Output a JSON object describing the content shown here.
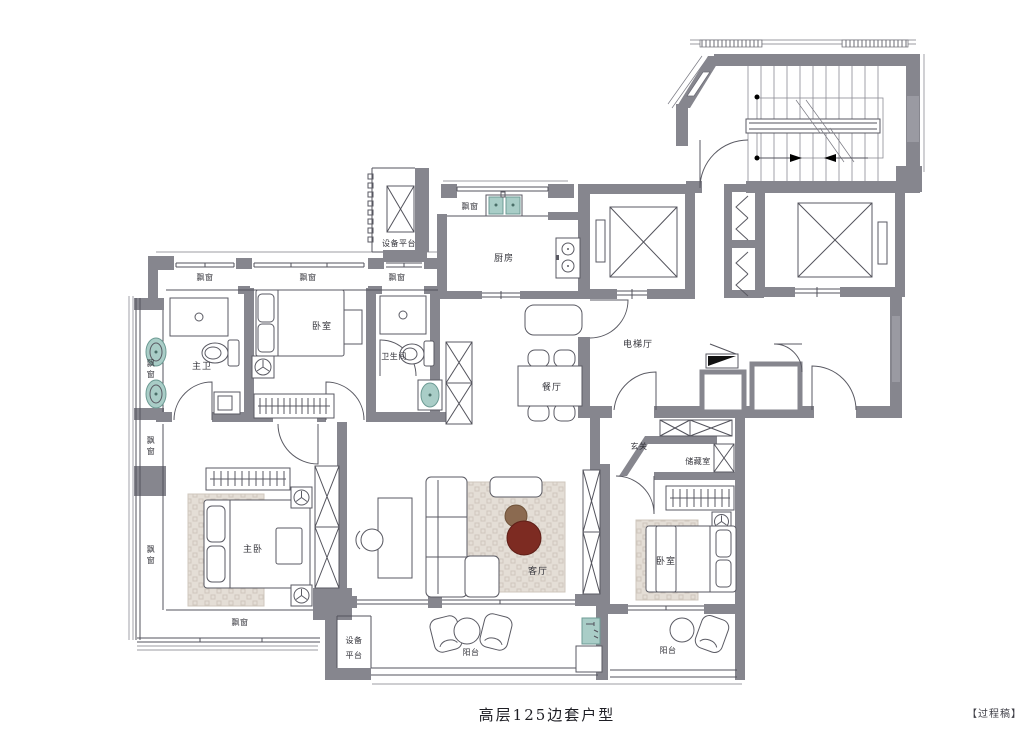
{
  "title": "高层125边套户型",
  "watermark": "【过程稿】",
  "labels": {
    "bay_window": "飘窗",
    "equipment_platform": "设备平台",
    "equipment_platform_line1": "设备",
    "equipment_platform_line2": "平台",
    "kitchen": "厨房",
    "bedroom": "卧室",
    "master_bath": "主卫",
    "bathroom": "卫生间",
    "dining_room": "餐厅",
    "elevator_hall": "电梯厅",
    "foyer": "玄关",
    "storage_room": "储藏室",
    "master_bedroom": "主卧",
    "living_room": "客厅",
    "balcony": "阳台"
  },
  "colors": {
    "wall_gray": "#86868e",
    "fixture_teal": "#a9cdc7",
    "coffee_table_red": "#7d2b22",
    "coffee_table_brown": "#8b6a50",
    "rug_tan": "#e4ded6",
    "background": "#ffffff"
  }
}
